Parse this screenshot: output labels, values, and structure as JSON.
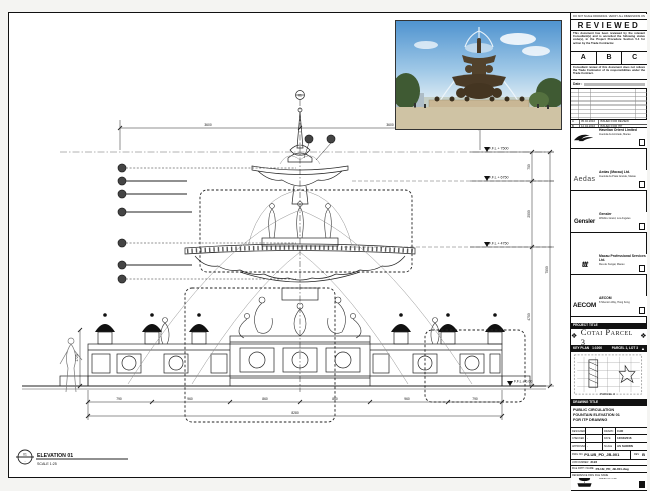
{
  "sheet": {
    "margin_note": "DO NOT SCALE DRAWINGS. VERIFY ALL DIMENSIONS ON SITE."
  },
  "stamp": {
    "title": "REVIEWED",
    "para1": "This document has been reviewed by the relevant Consultant(s) and is accorded the following status code(s), in the Project Procedure Section 5.4 for action by the Trade Contractor.",
    "codes": [
      "A",
      "B",
      "C"
    ],
    "para2": "Consultant review of this document does not relieve the Trade Contractor of its responsibilities under the Trade Contract.",
    "date_label": "Date :"
  },
  "revisions": {
    "rows": [
      {
        "rev": "A",
        "date": "05.02.2016",
        "desc": "ISSUED FOR REVIEW"
      },
      {
        "rev": "B",
        "date": "12.04.2016",
        "desc": "ISSUED FOR ITP"
      }
    ]
  },
  "consultants": [
    {
      "name": "Havelian Orient Limited",
      "addr": "Avenida da Amizade, Macau"
    },
    {
      "logo_text": "Aedas",
      "name": "Aedas (Macau) Ltd.",
      "addr": "Avenida da Praia Grande, Macau"
    },
    {
      "logo_text": "Gensler",
      "name": "Gensler",
      "addr": "Wilshire Grand, Los Angeles"
    },
    {
      "logo_text": "ttt",
      "name": "Macau Professional Services Ltd.",
      "addr": "Rua de Xangai, Macau"
    },
    {
      "logo_text": "AECOM",
      "name": "AECOM",
      "addr": "8 Shenton Way, Hong Kong"
    },
    {
      "logo_text": "LangdonSeah",
      "name": "Langdon Seah",
      "addr": "Hong Kong"
    }
  ],
  "contractor": {
    "name": "Youke Construction (Macau) CO., LTD.",
    "addr1": "Alameda Dr. Carlos d'Assumpcao",
    "addr2": "Macau  Tel / Fax"
  },
  "project": {
    "bar": "PROJECT TITLE",
    "title": "Cotai Parcel 3"
  },
  "keyplan": {
    "bar": "KEY PLAN",
    "scale": "1:1000",
    "parcel": "PARCEL 1, LOT 3",
    "inner_label": "PARCEL 3"
  },
  "drawingtitle": {
    "bar": "DRAWING TITLE",
    "lines": [
      "PUBLIC CIRCULATION",
      "FOUNTAIN ELEVATION 01",
      "FOR ITP DRAWING"
    ]
  },
  "meta": {
    "designed_label": "DESIGNED",
    "designed": "",
    "drawn_label": "DRAWN",
    "drawn": "CAD",
    "checked_label": "CHECKED",
    "checked": "-",
    "date_label": "DATE",
    "date": "12/04/2016",
    "approved_label": "APPROVED",
    "approved": "-",
    "scale_label": "SCALE",
    "scale": "AS SHOWN"
  },
  "dwg": {
    "label": "DWG NO.",
    "value": "P3-UB_PD_JB-001",
    "rev_label": "REV",
    "rev": "B"
  },
  "job": {
    "label": "JOB NUMBER",
    "value": "3123"
  },
  "file": {
    "label": "FILE PATH / NAME",
    "value": "P3-UB_PD_JB-001.dwg"
  },
  "ref": {
    "label": "REFERENCE DWG FILE NAME",
    "value": ""
  },
  "elevation": {
    "num": "01",
    "sub": "-",
    "title": "ELEVATION 01",
    "scale": "SCALE 1:25"
  },
  "levels": [
    "F.F.L + 7500",
    "F.F.L + 6750",
    "F.F.L + 4750",
    "F.F.L ± 0.00"
  ],
  "dims": {
    "top": [
      "3600",
      "3600"
    ],
    "right": [
      "750",
      "2000",
      "4750",
      "7500"
    ],
    "left_base": "1725",
    "bottom": [
      "790",
      "960",
      "860",
      "860",
      "960",
      "790"
    ],
    "bottom_total": "8280"
  }
}
